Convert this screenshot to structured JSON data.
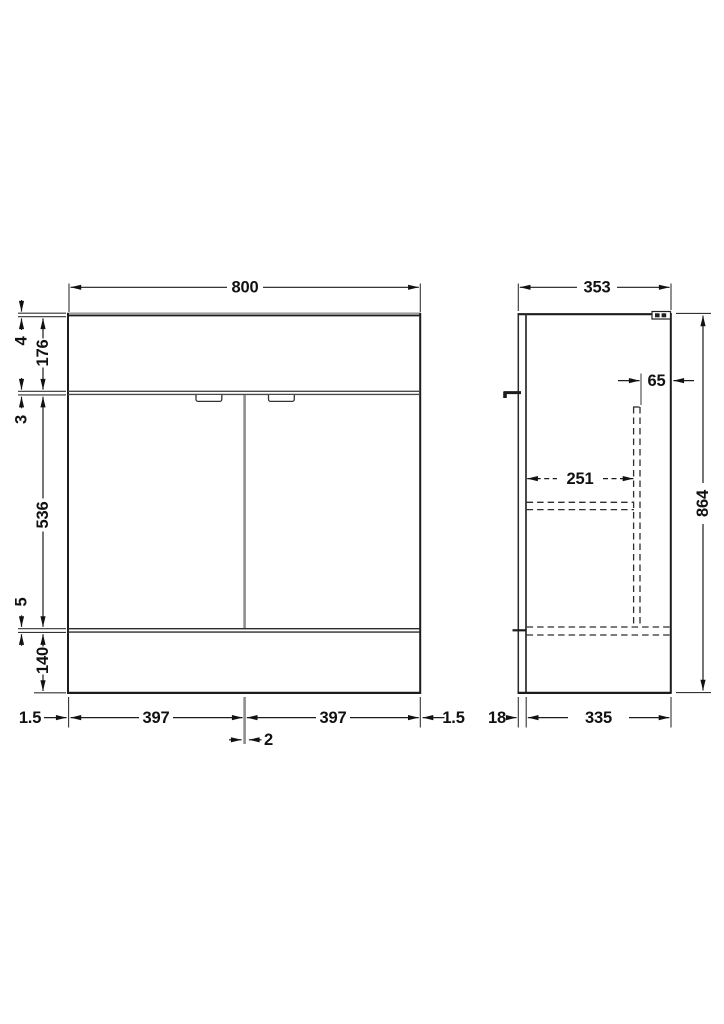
{
  "drawing": {
    "title": "vanity-unit-dimension-drawing",
    "front": {
      "width": "800",
      "lip": "4",
      "worktop_band": "176",
      "top_gap": "3",
      "door_height": "536",
      "bottom_gap": "5",
      "plinth": "140",
      "edge_left": "1.5",
      "left_door_width": "397",
      "right_door_width": "397",
      "edge_right": "1.5",
      "door_gap": "2"
    },
    "side": {
      "depth": "353",
      "height": "864",
      "service_gap": "65",
      "internal_depth": "251",
      "door_thickness": "18",
      "carcass_depth": "335"
    }
  }
}
